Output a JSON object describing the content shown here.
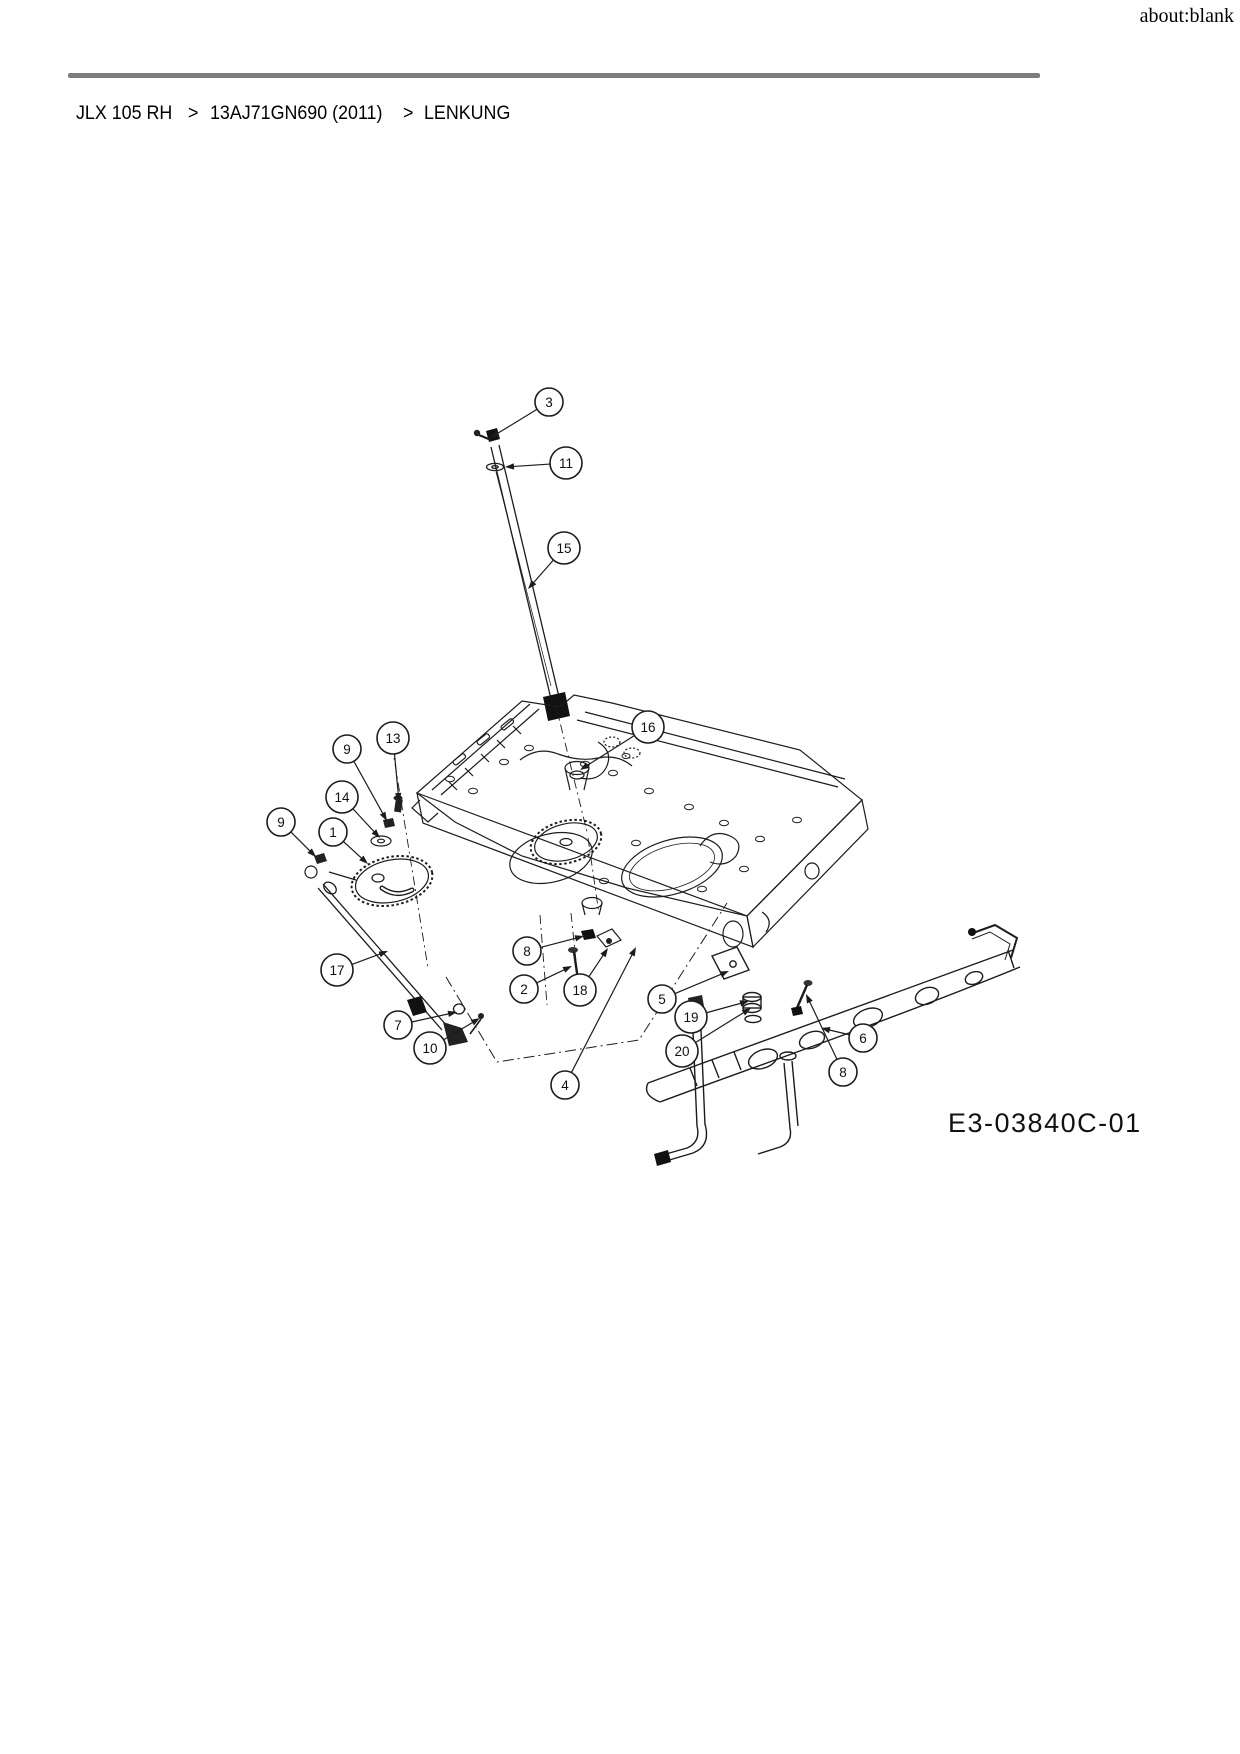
{
  "page": {
    "header_right": "about:blank"
  },
  "breadcrumb": {
    "parts": [
      "JLX 105 RH",
      ">",
      "13AJ71GN690 (2011)",
      ">",
      "LENKUNG"
    ]
  },
  "diagram": {
    "drawing_number": "E3-03840C-01",
    "callouts": [
      {
        "n": 3,
        "x": 549,
        "y": 402,
        "tx": 490,
        "ty": 438
      },
      {
        "n": 11,
        "x": 566,
        "y": 463,
        "tx": 505,
        "ty": 467
      },
      {
        "n": 15,
        "x": 564,
        "y": 548,
        "tx": 528,
        "ty": 589
      },
      {
        "n": 16,
        "x": 648,
        "y": 727,
        "tx": 580,
        "ty": 770
      },
      {
        "n": 13,
        "x": 393,
        "y": 738,
        "tx": 399,
        "ty": 802
      },
      {
        "n": 9,
        "x": 347,
        "y": 749,
        "tx": 387,
        "ty": 821
      },
      {
        "n": 14,
        "x": 342,
        "y": 797,
        "tx": 380,
        "ty": 838
      },
      {
        "n": 1,
        "x": 333,
        "y": 832,
        "tx": 368,
        "ty": 864
      },
      {
        "n": 9,
        "x": 281,
        "y": 822,
        "tx": 316,
        "ty": 857
      },
      {
        "n": 17,
        "x": 337,
        "y": 970,
        "tx": 388,
        "ty": 951
      },
      {
        "n": 7,
        "x": 398,
        "y": 1025,
        "tx": 457,
        "ty": 1012
      },
      {
        "n": 10,
        "x": 430,
        "y": 1048,
        "tx": 480,
        "ty": 1018
      },
      {
        "n": 8,
        "x": 527,
        "y": 951,
        "tx": 584,
        "ty": 936
      },
      {
        "n": 2,
        "x": 524,
        "y": 989,
        "tx": 572,
        "ty": 966
      },
      {
        "n": 18,
        "x": 580,
        "y": 990,
        "tx": 608,
        "ty": 948
      },
      {
        "n": 4,
        "x": 565,
        "y": 1085,
        "tx": 636,
        "ty": 947
      },
      {
        "n": 5,
        "x": 662,
        "y": 999,
        "tx": 729,
        "ty": 971
      },
      {
        "n": 19,
        "x": 691,
        "y": 1017,
        "tx": 749,
        "ty": 1001
      },
      {
        "n": 20,
        "x": 682,
        "y": 1051,
        "tx": 751,
        "ty": 1008
      },
      {
        "n": 6,
        "x": 863,
        "y": 1038,
        "tx": 821,
        "ty": 1028
      },
      {
        "n": 8,
        "x": 843,
        "y": 1072,
        "tx": 806,
        "ty": 994
      }
    ]
  },
  "colors": {
    "divider": "#7d7d7d",
    "line": "#1c1c1c",
    "background": "#ffffff"
  }
}
